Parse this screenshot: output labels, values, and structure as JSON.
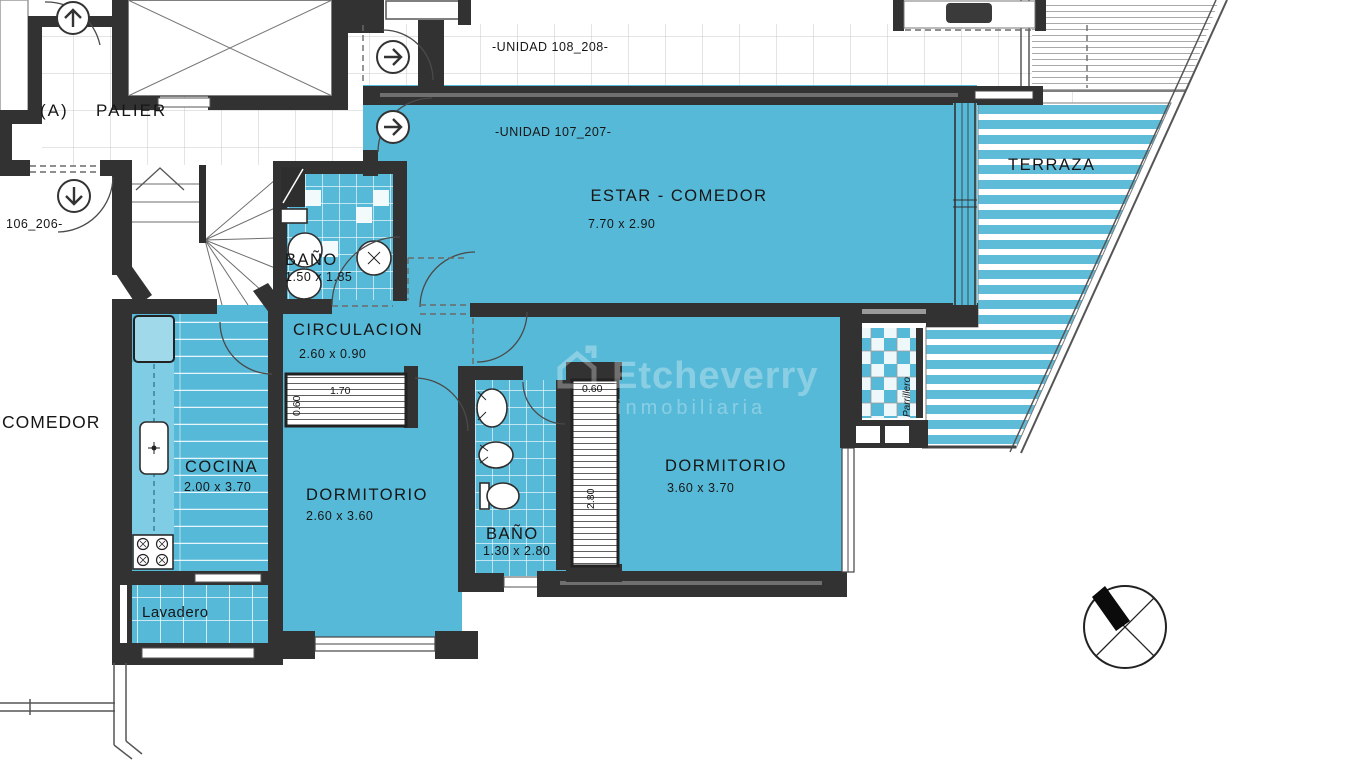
{
  "plan": {
    "building_section_letter": "(A)",
    "common": {
      "palier": "PALIER",
      "unit_108": "-UNIDAD 108_208-",
      "unit_107": "-UNIDAD 107_207-",
      "unit_106": "106_206-",
      "neighbor_room": "COMEDOR"
    },
    "rooms": {
      "estar_comedor": {
        "name": "ESTAR - COMEDOR",
        "dim": "7.70 x 2.90"
      },
      "terraza": {
        "name": "TERRAZA"
      },
      "bano_1": {
        "name": "BAÑO",
        "dim": "1.50 x 1.85"
      },
      "circulacion": {
        "name": "CIRCULACION",
        "dim": "2.60 x 0.90"
      },
      "cocina": {
        "name": "COCINA",
        "dim": "2.00 x 3.70"
      },
      "dormitorio_1": {
        "name": "DORMITORIO",
        "dim": "2.60 x 3.60"
      },
      "bano_2": {
        "name": "BAÑO",
        "dim": "1.30 x 2.80"
      },
      "dormitorio_2": {
        "name": "DORMITORIO",
        "dim": "3.60 x 3.70"
      },
      "lavadero": {
        "name": "Lavadero"
      },
      "parrillero": {
        "name": "Parrillero"
      }
    },
    "closets": {
      "placard_1_depth": "0.60",
      "placard_1_width": "1.70",
      "placard_2_depth": "0.60",
      "placard_2_height": "2.80"
    },
    "watermark": {
      "brand": "Etcheverry",
      "tagline": "inmobiliaria"
    },
    "colors": {
      "room_fill": "#57b9d8",
      "counter_fill": "#7fcde4",
      "wall": "#323232",
      "stripe_blue": "#5fbcd9"
    }
  }
}
